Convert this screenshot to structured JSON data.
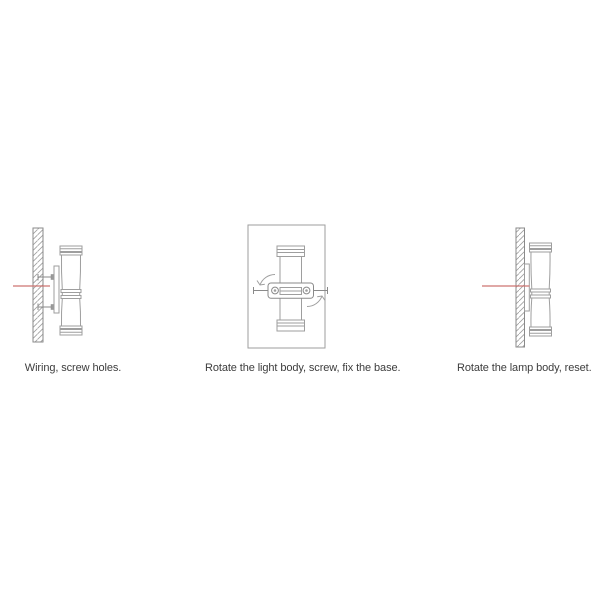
{
  "title": "Wall lamp installation instructions",
  "colors": {
    "background": "#ffffff",
    "line": "#9e9e9e",
    "line_dark": "#8a8a8a",
    "wire_red": "#cd7471",
    "caption": "#3d3d3d",
    "screw_fill": "#9a9a9a"
  },
  "steps": [
    {
      "caption": "Wiring, screw holes.",
      "illustration": "side-view-wall-with-wire-and-screws",
      "icons": [
        "wall-cross-section-icon",
        "wire-line-icon",
        "screw-icon",
        "mounting-plate-icon",
        "lamp-side-view-icon"
      ]
    },
    {
      "caption": "Rotate the light body, screw, fix the base.",
      "illustration": "front-view-lamp-bracket-screws-rotation",
      "icons": [
        "wall-front-view-icon",
        "lamp-front-view-icon",
        "mounting-bracket-icon",
        "screw-icon",
        "rotation-arrow-icon"
      ]
    },
    {
      "caption": "Rotate the lamp body, reset.",
      "illustration": "side-view-lamp-mounted-flush",
      "icons": [
        "wall-cross-section-icon",
        "wire-line-icon",
        "mounting-plate-icon",
        "lamp-side-view-icon"
      ]
    }
  ]
}
